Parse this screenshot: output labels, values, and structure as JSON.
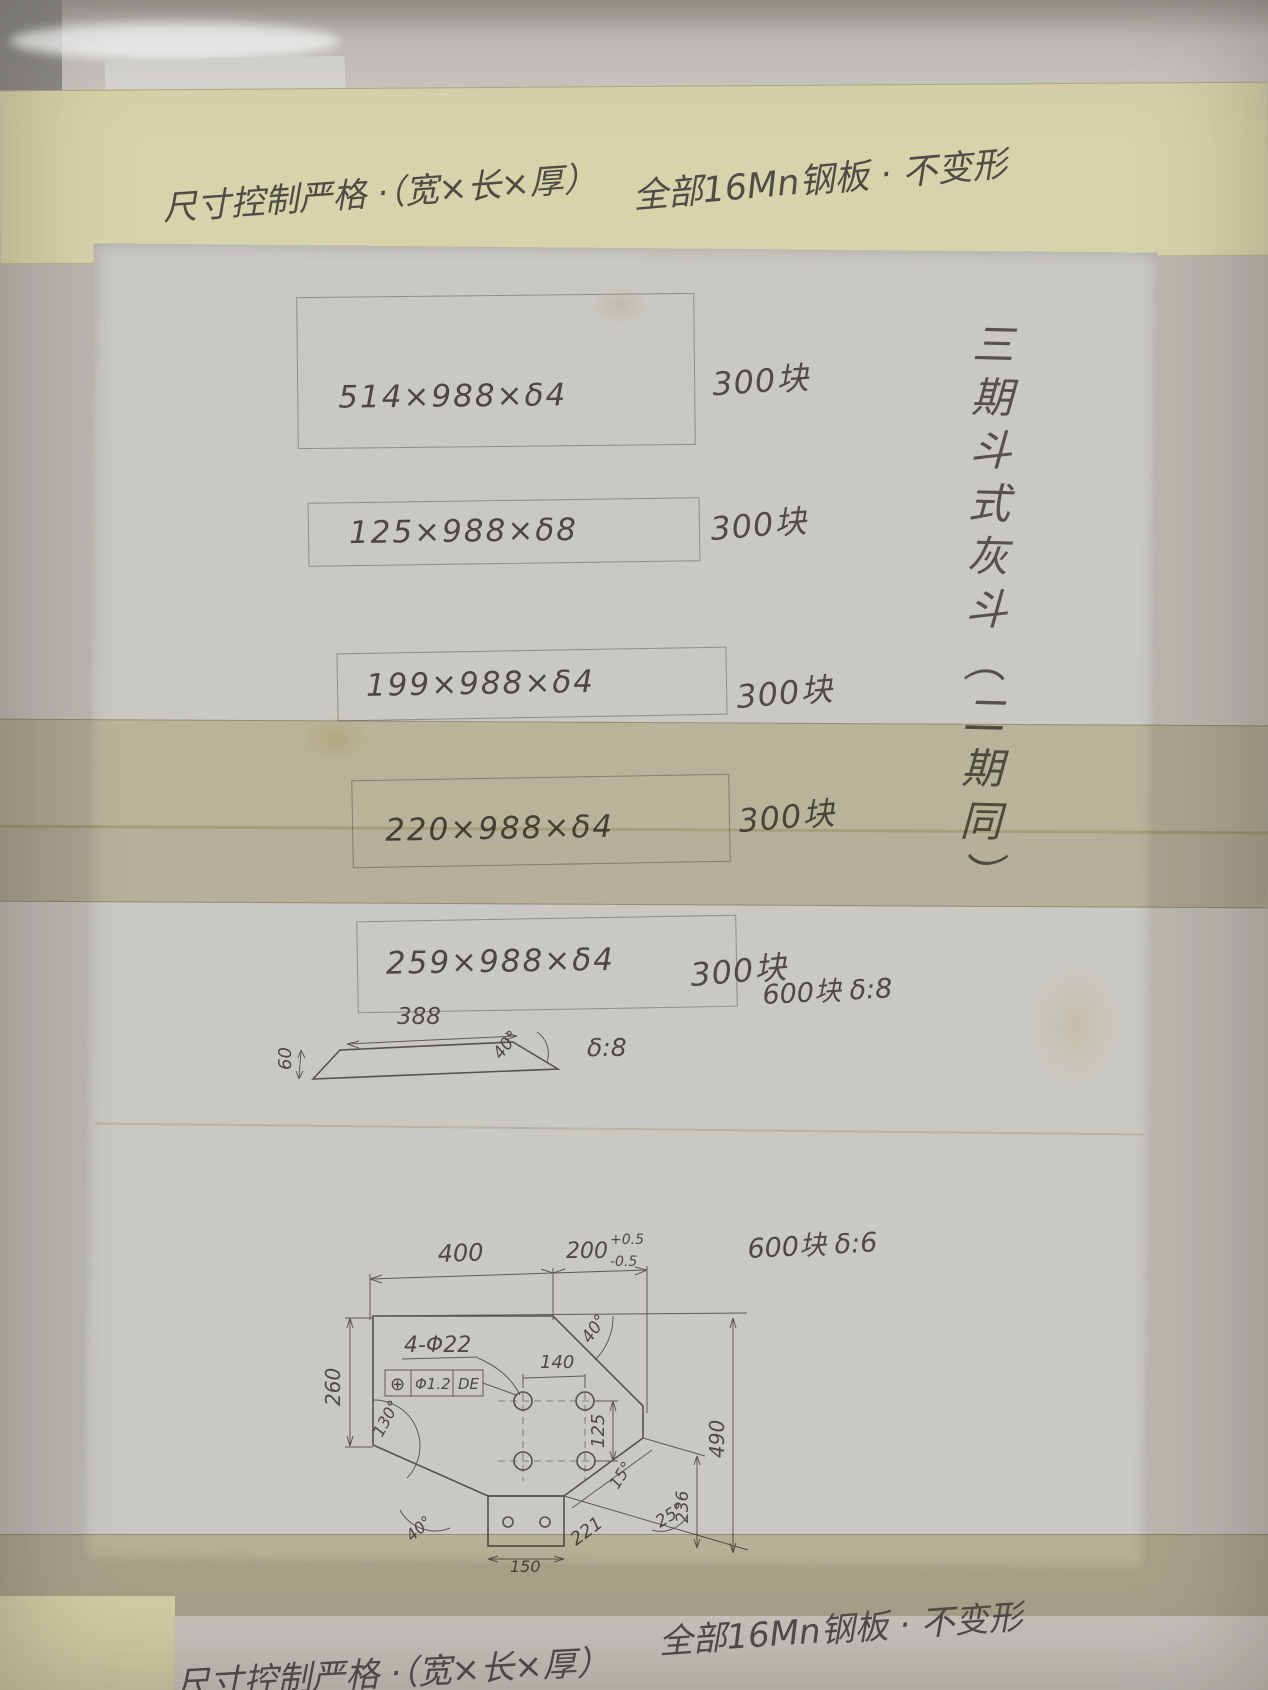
{
  "header": {
    "left": "尺寸控制严格 ·（宽×长×厚）",
    "right": "全部16Mn钢板 · 不变形"
  },
  "side_note_vertical": "三期斗式灰斗（二期同）",
  "plates": [
    {
      "size": "514×988×δ4",
      "qty": "300块"
    },
    {
      "size": "125×988×δ8",
      "qty": "300块"
    },
    {
      "size": "199×988×δ4",
      "qty": "300块"
    },
    {
      "size": "220×988×δ4",
      "qty": "300块"
    },
    {
      "size": "259×988×δ4",
      "qty": "300块"
    }
  ],
  "strip_sketch": {
    "width": "388",
    "height": "60",
    "angle": "40°",
    "thickness": "δ:8",
    "qty_note": "600块  δ:8"
  },
  "plate_drawing": {
    "qty_note": "600块 δ:6",
    "dim_top_left": "400",
    "dim_top_right": "200",
    "tol_plus": "+0.5",
    "tol_minus": "-0.5",
    "holes_label": "4-Φ22",
    "fcf_symbol": "⊕",
    "fcf_tol": "Φ1.2",
    "fcf_datum": "DE",
    "dim_hole_h": "140",
    "dim_hole_v": "125",
    "dim_left": "260",
    "dim_right": "490",
    "dim_right_inner": "236",
    "dim_slant": "221",
    "dim_tab": "150",
    "angle_top": "40°",
    "angle_left": "130°",
    "angle_bottom_left": "40°",
    "angle_right_1": "15°",
    "angle_right_2": "25°"
  },
  "footer": {
    "left": "尺寸控制严格 ·（宽×长×厚）",
    "right": "全部16Mn钢板 · 不变形"
  }
}
